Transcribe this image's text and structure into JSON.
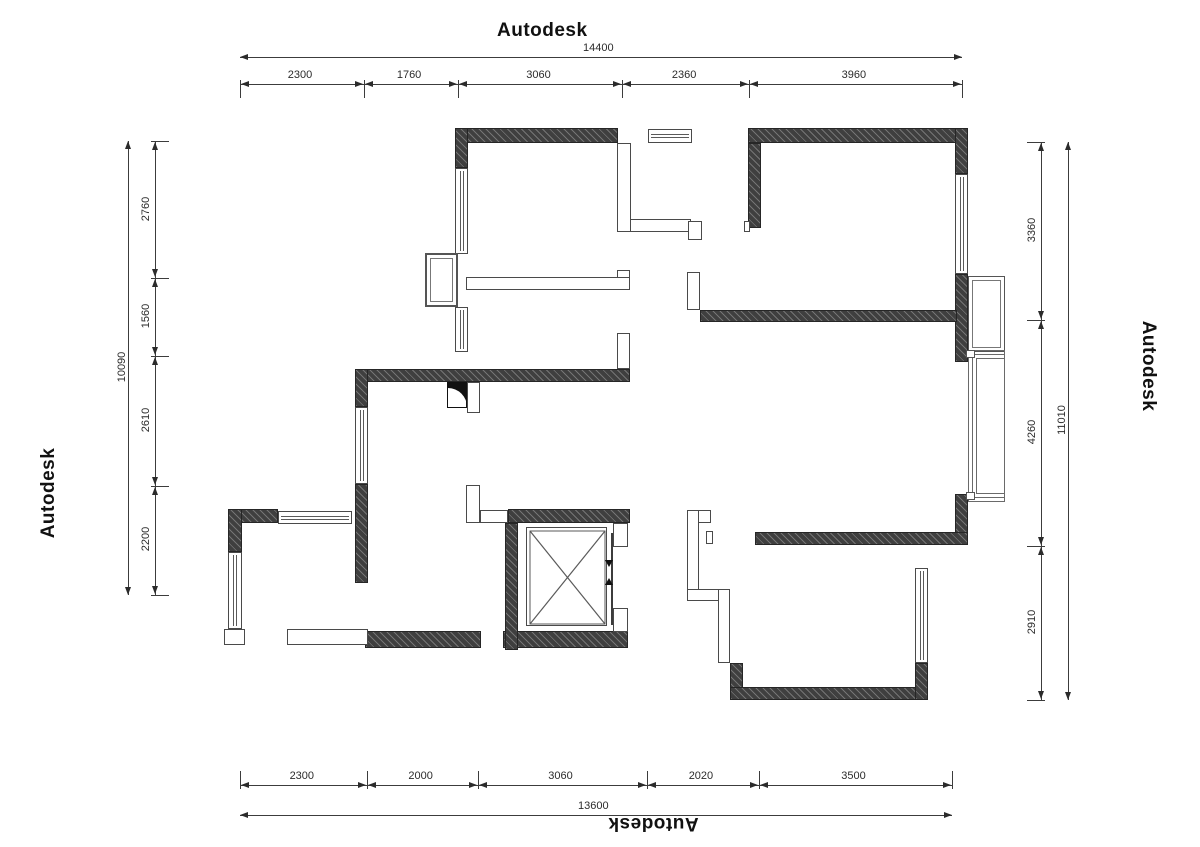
{
  "watermarks": {
    "top": "Autodesk",
    "left": "Autodesk",
    "right": "Autodesk",
    "bottom": "Autodesk"
  },
  "dimensions": {
    "top": {
      "total": 14400,
      "segments": [
        2300,
        1760,
        3060,
        2360,
        3960
      ],
      "span": [
        240,
        962
      ],
      "seg_line_y": 84,
      "total_line_y": 57,
      "label_side": "above",
      "witness_dir": 1
    },
    "bottom": {
      "total": 13600,
      "segments": [
        2300,
        2000,
        3060,
        2020,
        3500
      ],
      "span": [
        240,
        952
      ],
      "seg_line_y": 785,
      "total_line_y": 815,
      "label_side": "above",
      "witness_dir": -1
    },
    "left": {
      "total": 10090,
      "segments": [
        2760,
        1560,
        2610,
        2200
      ],
      "span": [
        141,
        595
      ],
      "seg_line_x": 155,
      "total_line_x": 128,
      "witness_dir": 1
    },
    "right": {
      "total": 11010,
      "segments": [
        3360,
        4260,
        2910
      ],
      "span": [
        142,
        700
      ],
      "seg_line_x": 1041,
      "total_line_x": 1068,
      "witness_dir": -1
    }
  },
  "plan": {
    "colors": {
      "wall": "#3f3f3f",
      "line": "#4a4a4a",
      "dim": "#2b2b2b",
      "background": "#ffffff"
    },
    "walls": [
      [
        455,
        128,
        163,
        15
      ],
      [
        748,
        128,
        220,
        15
      ],
      [
        455,
        128,
        13,
        40
      ],
      [
        955,
        128,
        13,
        46
      ],
      [
        955,
        274,
        13,
        88
      ],
      [
        955,
        494,
        13,
        51
      ],
      [
        748,
        143,
        13,
        85
      ],
      [
        700,
        310,
        257,
        12
      ],
      [
        358,
        369,
        272,
        13
      ],
      [
        355,
        369,
        13,
        38
      ],
      [
        355,
        484,
        13,
        99
      ],
      [
        228,
        509,
        50,
        14
      ],
      [
        228,
        509,
        14,
        43
      ],
      [
        365,
        631,
        116,
        17
      ],
      [
        503,
        631,
        125,
        17
      ],
      [
        508,
        509,
        122,
        14
      ],
      [
        505,
        523,
        13,
        127
      ],
      [
        755,
        532,
        213,
        13
      ],
      [
        730,
        663,
        13,
        37
      ],
      [
        730,
        687,
        198,
        13
      ],
      [
        915,
        663,
        13,
        37
      ]
    ],
    "partitions": [
      [
        617,
        143,
        14,
        89
      ],
      [
        630,
        219,
        61,
        13
      ],
      [
        688,
        221,
        14,
        19
      ],
      [
        466,
        277,
        164,
        13
      ],
      [
        617,
        270,
        13,
        8
      ],
      [
        687,
        272,
        13,
        38
      ],
      [
        617,
        333,
        13,
        36
      ],
      [
        466,
        485,
        14,
        38
      ],
      [
        480,
        510,
        28,
        13
      ],
      [
        613,
        523,
        15,
        24
      ],
      [
        613,
        608,
        15,
        24
      ],
      [
        744,
        221,
        6,
        11
      ],
      [
        287,
        629,
        81,
        16
      ],
      [
        224,
        629,
        21,
        16
      ],
      [
        467,
        382,
        13,
        31
      ],
      [
        687,
        510,
        24,
        13
      ],
      [
        687,
        510,
        12,
        90
      ],
      [
        706,
        531,
        7,
        13
      ],
      [
        687,
        589,
        43,
        12
      ],
      [
        718,
        589,
        12,
        74
      ]
    ],
    "windows": [
      {
        "rect": [
          455,
          168,
          13,
          86
        ],
        "orient": "v"
      },
      {
        "rect": [
          455,
          307,
          13,
          45
        ],
        "orient": "v"
      },
      {
        "rect": [
          648,
          129,
          44,
          14
        ],
        "orient": "h"
      },
      {
        "rect": [
          955,
          174,
          13,
          100
        ],
        "orient": "v"
      },
      {
        "rect": [
          355,
          407,
          13,
          77
        ],
        "orient": "v"
      },
      {
        "rect": [
          278,
          511,
          74,
          13
        ],
        "orient": "h"
      },
      {
        "rect": [
          228,
          552,
          14,
          77
        ],
        "orient": "v"
      },
      {
        "rect": [
          915,
          568,
          13,
          95
        ],
        "orient": "v"
      }
    ],
    "flue_box": {
      "rect": [
        425,
        253,
        33,
        54
      ]
    },
    "door_swing": {
      "rect": [
        447,
        382,
        20,
        26
      ]
    },
    "elevator": {
      "rect": [
        526,
        527,
        81,
        99
      ],
      "door_x": 611,
      "door_y1": 533,
      "door_y2": 625
    },
    "bay_window": {
      "upper": [
        968,
        276,
        37,
        76
      ],
      "lower": [
        968,
        350,
        37,
        152
      ],
      "nest_inset": 4,
      "corner_squares": [
        [
          966,
          350,
          9,
          8
        ],
        [
          966,
          492,
          9,
          8
        ]
      ]
    }
  }
}
